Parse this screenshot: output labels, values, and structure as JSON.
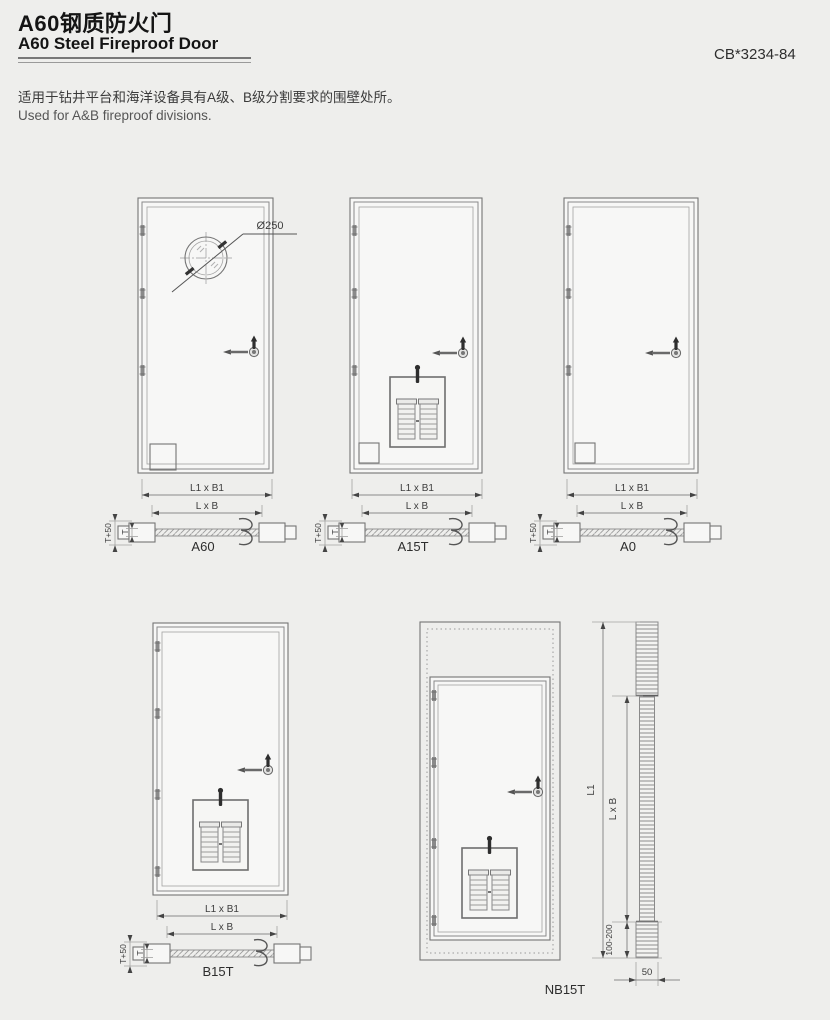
{
  "page": {
    "title_zh": "A60钢质防火门",
    "title_en": "A60 Steel Fireproof Door",
    "standard_code": "CB*3234-84",
    "desc_zh": "适用于钻井平台和海洋设备具有A级、B级分割要求的围壁处所。",
    "desc_en": "Used for A&B fireproof divisions."
  },
  "drawing": {
    "porthole_dia": "Ø250",
    "dim_outer": "L1 x B1",
    "dim_inner": "L x B",
    "dim_thickness_plus": "T+50",
    "dim_thickness": "T",
    "dim_height": "L1",
    "dim_clear": "L x B",
    "dim_sill": "100-200",
    "dim_width": "50"
  },
  "doors": [
    {
      "name": "A60"
    },
    {
      "name": "A15T"
    },
    {
      "name": "A0"
    },
    {
      "name": "B15T"
    },
    {
      "name": "NB15T"
    }
  ],
  "colors": {
    "background": "#eeeeec",
    "line": "#8a8a8a",
    "text": "#3f3f3f"
  }
}
